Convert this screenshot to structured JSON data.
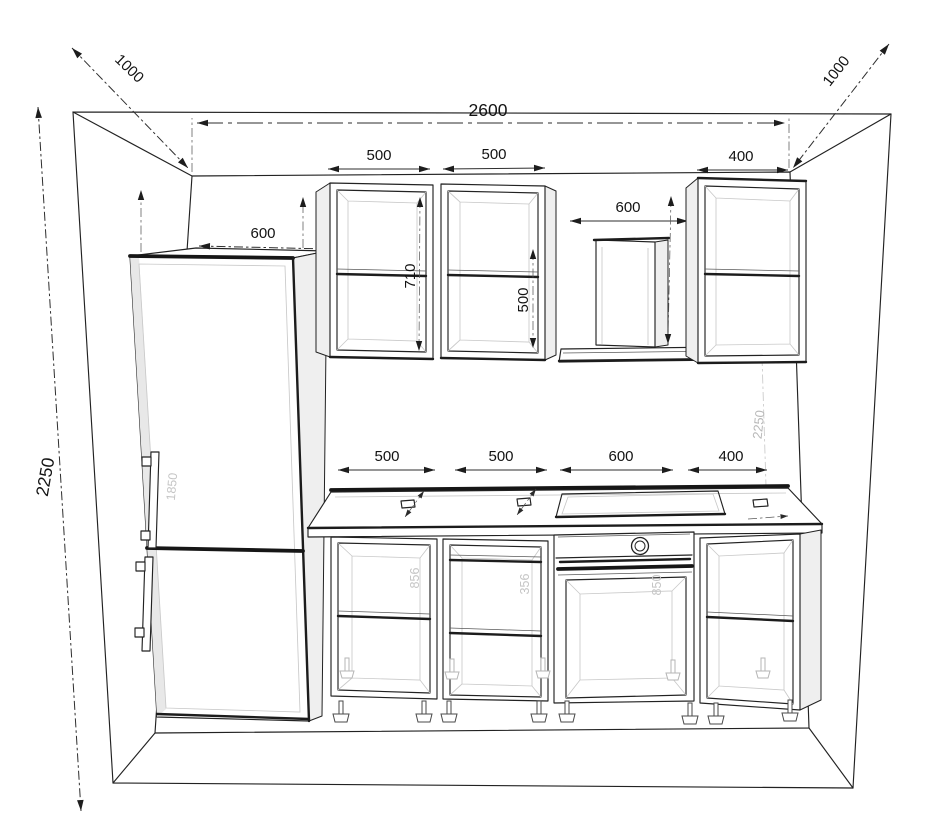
{
  "style": {
    "background": "#ffffff",
    "line_color": "#222222",
    "dimension_text_color": "#131313",
    "ghost_text_color": "#c5c5c5"
  },
  "dimensions": {
    "room": {
      "width": "2600",
      "height_left": "2250",
      "height_right": "2250",
      "depth_left": "1000",
      "depth_right": "1000"
    },
    "fridge": {
      "width": "600",
      "niche_height_ghost": "1850"
    },
    "upper_cabinets": {
      "cabinet1_width": "500",
      "cabinet2_width": "500",
      "hood_gap_width": "600",
      "cabinet3_width": "400",
      "cabinet1_inner_height": "710",
      "cabinet2_inner_height": "500"
    },
    "base_cabinets": {
      "cabinet1_width": "500",
      "cabinet2_width": "500",
      "oven_cabinet_width": "600",
      "cabinet4_width": "400",
      "cabinet1_inner_height_ghost": "856",
      "cabinet2_inner_height_ghost": "356",
      "oven_inner_height_ghost": "850"
    }
  }
}
